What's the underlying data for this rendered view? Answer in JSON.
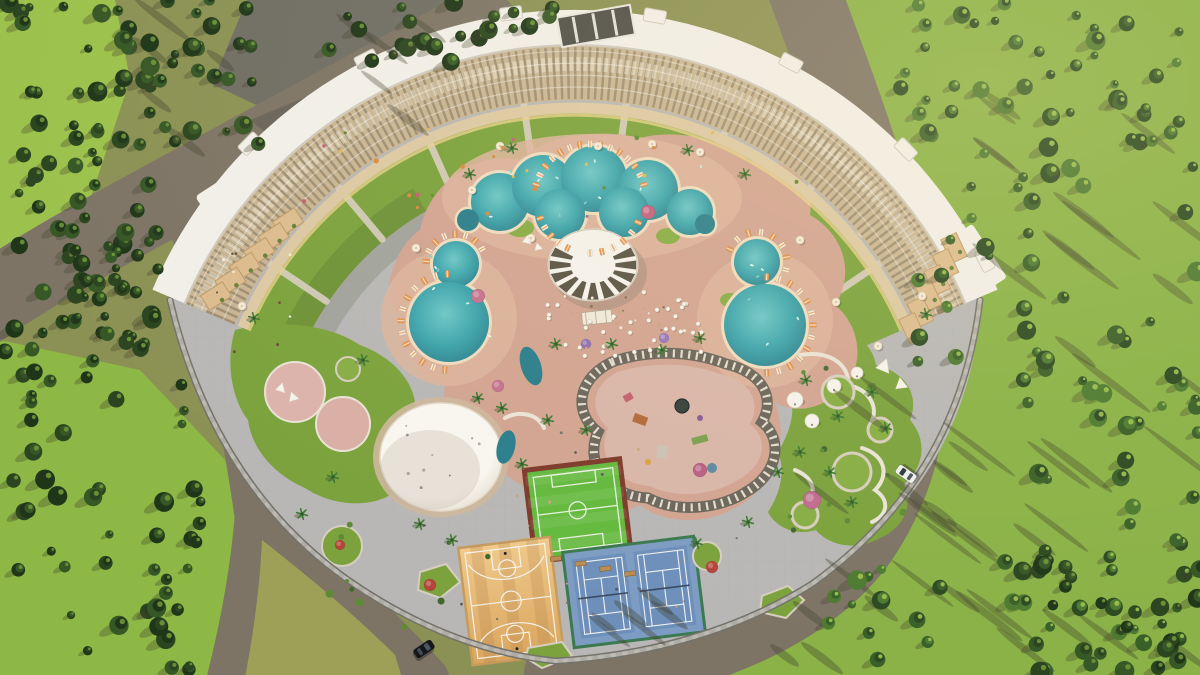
{
  "scene": {
    "kind": "aerial-architectural-render",
    "elements": [
      "curved-hotel-building",
      "swimming-pools",
      "central-sun-canopy",
      "event-dome",
      "mini-football-court",
      "tennis-courts",
      "basketball-court",
      "kids-playground",
      "lazy-track",
      "gardens",
      "perimeter-wall",
      "forest",
      "roads",
      "cars"
    ]
  },
  "colors": {
    "groundOlive": "#8b9154",
    "groundBright": "#8ab247",
    "groundLime": "#9cc14c",
    "bottomLeftBright": "#8db846",
    "medianOlive": "#9fa058",
    "asphalt": "#6f6d64",
    "asphaltShadow": "#55544d",
    "road": "#7d7466",
    "wallLight": "#aeaca4",
    "wallDark": "#73726b",
    "wallPost": "#c9c7c0",
    "plaza": "#b8b7b6",
    "plazaLine": "#a7a6a5",
    "deck": "#d2a492",
    "deckLight": "#ddb49e",
    "island": "#d9b6a9",
    "padPink": "#dcb3ab",
    "padPink2": "#d9aea6",
    "lawn": "#7ba23d",
    "lawnBright": "#87ad45",
    "pathLight": "#d7cec0",
    "gardenPath": "#e9e3d7",
    "water": "#3da5ad",
    "waterDeep": "#2a7e8c",
    "waterLight": "#6cc7c8",
    "poolRim": "#eedcc0",
    "canopyWhite": "#f4f2ec",
    "canopyStripe": "#4c4636",
    "canopyShadow": "#8f8273",
    "roofWhite": "#f1efe9",
    "roofGray": "#d3d6d1",
    "roofEdge": "#cfcabf",
    "facadeTan": "#c9b593",
    "facadeDark": "#6b604f",
    "facadeLight": "#f0e9da",
    "walkway": "#dcc9a4",
    "walkwayEdge": "#e6d089",
    "terraceTan": "#dcbc8f",
    "terraceEdge": "#bd9a68",
    "rampDark": "#4f4e49",
    "courtGreen": "#63b93e",
    "courtBorderRed": "#7c3a2b",
    "tennisBlue": "#7d9cc3",
    "tennisInner": "#6d8fba",
    "tennisEdge": "#3c7950",
    "netDark": "#3a4a63",
    "woodLight": "#f0ca8c",
    "woodDark": "#d9a55e",
    "woodEdge": "#c59c5e",
    "lineWhite": "#f7f7f4",
    "benchTan": "#b98c54",
    "loungerOrange": "#e79346",
    "loungerWhite": "#f3ece0",
    "umbrellaCream": "#f3ead8",
    "tentWhite": "#f6f3ec",
    "palmDark": "#2e5b2a",
    "palmFrond": "#3f7a33",
    "treeShadow": "#3e3e2c",
    "domeWhite": "#f8f6f0",
    "domeEdge": "#e3d9ca",
    "domeRing": "#cdb79c",
    "treeDark1": "#1f3619",
    "treeDark2": "#2a451f",
    "treeDark3": "#365726",
    "treeMid1": "#2c4a22",
    "treeMid2": "#3a6029",
    "treeMid3": "#4d7a31",
    "treeCap": "#6f9638",
    "treeCapBright": "#9dc24f",
    "sunGlow": "#ffe9b0"
  },
  "procedural": {
    "forests": [
      {
        "box": [
          0,
          0,
          152,
          335
        ],
        "n": 62,
        "seed": 11,
        "pal": "dark"
      },
      {
        "box": [
          148,
          0,
          112,
          148
        ],
        "n": 26,
        "seed": 12,
        "pal": "dark"
      },
      {
        "box": [
          328,
          0,
          128,
          64
        ],
        "n": 14,
        "seed": 13,
        "pal": "dark"
      },
      {
        "box": [
          58,
          206,
          118,
          136
        ],
        "n": 18,
        "seed": 14,
        "pal": "dark"
      },
      {
        "box": [
          0,
          332,
          212,
          343
        ],
        "n": 56,
        "seed": 15,
        "pal": "dark"
      },
      {
        "box": [
          455,
          0,
          100,
          52
        ],
        "n": 9,
        "seed": 16,
        "pal": "dark"
      },
      {
        "box": [
          872,
          0,
          328,
          136
        ],
        "n": 40,
        "seed": 17,
        "pal": "mid"
      },
      {
        "box": [
          1002,
          132,
          198,
          543
        ],
        "n": 64,
        "seed": 18,
        "pal": "mid"
      },
      {
        "box": [
          903,
          132,
          104,
          232
        ],
        "n": 14,
        "seed": 19,
        "pal": "mid"
      },
      {
        "box": [
          1022,
          556,
          178,
          119
        ],
        "n": 26,
        "seed": 20,
        "pal": "dark"
      },
      {
        "box": [
          828,
          556,
          164,
          112
        ],
        "n": 12,
        "seed": 21,
        "pal": "mid"
      }
    ],
    "shadow_streaks": [
      {
        "box": [
          936,
          50,
          264,
          610
        ],
        "n": 30,
        "seed": 31,
        "len": [
          45,
          100
        ]
      },
      {
        "box": [
          818,
          360,
          172,
          280
        ],
        "n": 14,
        "seed": 32,
        "len": [
          35,
          80
        ]
      },
      {
        "box": [
          556,
          592,
          300,
          78
        ],
        "n": 9,
        "seed": 33,
        "len": [
          28,
          60
        ]
      },
      {
        "box": [
          150,
          14,
          282,
          128
        ],
        "n": 10,
        "seed": 34,
        "len": [
          30,
          70
        ]
      }
    ],
    "lounger_arcs": [
      {
        "cx": 590,
        "cy": 200,
        "r": 56,
        "a0": 196,
        "a1": 344,
        "n": 15
      },
      {
        "cx": 590,
        "cy": 200,
        "r": 53,
        "a0": 25,
        "a1": 90,
        "n": 6
      },
      {
        "cx": 590,
        "cy": 200,
        "r": 53,
        "a0": 115,
        "a1": 160,
        "n": 5
      },
      {
        "cx": 449,
        "cy": 322,
        "r": 48,
        "a0": 95,
        "a1": 268,
        "n": 13
      },
      {
        "cx": 456,
        "cy": 264,
        "r": 30,
        "a0": 185,
        "a1": 330,
        "n": 8
      },
      {
        "cx": 765,
        "cy": 325,
        "r": 48,
        "a0": -88,
        "a1": 88,
        "n": 13
      },
      {
        "cx": 757,
        "cy": 262,
        "r": 30,
        "a0": -155,
        "a1": 15,
        "n": 8
      }
    ],
    "tables": {
      "box": [
        545,
        292,
        158,
        64
      ],
      "n": 40,
      "seed": 41,
      "avoid": [
        593,
        265,
        56,
        46
      ]
    },
    "canopy": {
      "cx": 593,
      "cy": 265,
      "rx": 45,
      "ry": 36,
      "wedges": 16,
      "skip": [
        222,
        318
      ],
      "ri": 0.5,
      "ro": 0.97
    },
    "spokes": {
      "cx": 575,
      "cy": 469,
      "r0": 368,
      "r1": 300,
      "angles": [
        214,
        230,
        246,
        262,
        278,
        294,
        310,
        326
      ],
      "width": 7
    },
    "roof_bumps": {
      "angles": [
        225,
        243,
        262,
        280,
        298,
        316,
        333
      ],
      "radius": 460,
      "w": 22,
      "h": 13
    },
    "terrace_steps": [
      {
        "from": [
          288,
          222
        ],
        "to": [
          216,
          296
        ],
        "n": 6,
        "rot": -33,
        "w": 26,
        "h": 17
      },
      {
        "from": [
          954,
          248
        ],
        "to": [
          912,
          328
        ],
        "n": 6,
        "rot": 65,
        "w": 26,
        "h": 17
      }
    ],
    "pools": {
      "blob_circles": [
        [
          500,
          202,
          29
        ],
        [
          543,
          186,
          31
        ],
        [
          594,
          179,
          33
        ],
        [
          648,
          190,
          30
        ],
        [
          690,
          212,
          23
        ],
        [
          560,
          214,
          25
        ],
        [
          624,
          212,
          25
        ],
        [
          456,
          264,
          23
        ],
        [
          449,
          322,
          40
        ],
        [
          757,
          262,
          23
        ],
        [
          765,
          325,
          41
        ]
      ],
      "round_pools": [
        [
          468,
          220,
          11
        ],
        [
          705,
          224,
          10
        ],
        [
          868,
          228,
          9
        ]
      ],
      "crescents": [
        [
          531,
          366,
          10,
          20,
          -18
        ],
        [
          506,
          447,
          9,
          17,
          14
        ]
      ]
    },
    "palms": [
      [
        363,
        360
      ],
      [
        333,
        477
      ],
      [
        302,
        514
      ],
      [
        420,
        524
      ],
      [
        452,
        540
      ],
      [
        478,
        398
      ],
      [
        502,
        408
      ],
      [
        522,
        464
      ],
      [
        556,
        344
      ],
      [
        612,
        344
      ],
      [
        662,
        350
      ],
      [
        700,
        338
      ],
      [
        748,
        522
      ],
      [
        697,
        543
      ],
      [
        778,
        472
      ],
      [
        800,
        452
      ],
      [
        830,
        472
      ],
      [
        852,
        502
      ],
      [
        886,
        428
      ],
      [
        838,
        416
      ],
      [
        806,
        380
      ],
      [
        872,
        392
      ],
      [
        512,
        148
      ],
      [
        470,
        174
      ],
      [
        688,
        150
      ],
      [
        745,
        174
      ],
      [
        254,
        318
      ],
      [
        926,
        314
      ],
      [
        586,
        430
      ],
      [
        548,
        420
      ]
    ],
    "umbrellas": [
      [
        500,
        146
      ],
      [
        472,
        190
      ],
      [
        700,
        152
      ],
      [
        800,
        240
      ],
      [
        836,
        302
      ],
      [
        416,
        248
      ],
      [
        242,
        306
      ],
      [
        922,
        296
      ],
      [
        878,
        346
      ],
      [
        531,
        238
      ],
      [
        598,
        146
      ],
      [
        652,
        144
      ]
    ],
    "tents": [
      [
        795,
        400,
        8
      ],
      [
        812,
        421,
        7
      ],
      [
        834,
        386,
        7
      ],
      [
        857,
        373,
        6
      ]
    ],
    "sails": [
      [
        884,
        366,
        13,
        20
      ],
      [
        901,
        384,
        11,
        -10
      ],
      [
        281,
        388,
        9,
        15
      ],
      [
        293,
        397,
        9,
        -20
      ],
      [
        527,
        240,
        8,
        10
      ],
      [
        538,
        247,
        7,
        -15
      ]
    ],
    "flowers": [
      [
        648,
        212,
        7,
        "#c2607f"
      ],
      [
        812,
        500,
        9,
        "#c06a8f"
      ],
      [
        700,
        470,
        7,
        "#b85f85"
      ],
      [
        478,
        296,
        7,
        "#c4728f"
      ],
      [
        586,
        344,
        5,
        "#8f6fb5"
      ],
      [
        664,
        338,
        5,
        "#9a77bf"
      ],
      [
        712,
        567,
        6,
        "#b5443a"
      ],
      [
        430,
        585,
        6,
        "#b5443a"
      ],
      [
        340,
        545,
        5,
        "#b5443a"
      ],
      [
        498,
        386,
        6,
        "#c4728f"
      ]
    ],
    "bush_clusters": [
      {
        "box": [
          788,
          352,
          140,
          180
        ],
        "n": 12,
        "seed": 58
      },
      {
        "box": [
          300,
          520,
          200,
          110
        ],
        "n": 10,
        "seed": 59
      }
    ],
    "people_clusters": [
      {
        "box": [
          548,
          292,
          150,
          62
        ],
        "n": 24,
        "seed": 51,
        "colors": [
          "#f2ead9",
          "#caa27d",
          "#8f6f52"
        ],
        "r": 1.2
      },
      {
        "box": [
          410,
          430,
          340,
          190
        ],
        "n": 18,
        "seed": 52,
        "colors": [
          "#5a5a55",
          "#77736a",
          "#caa27d"
        ],
        "r": 1.2
      },
      {
        "box": [
          300,
          120,
          500,
          110
        ],
        "n": 26,
        "seed": 53,
        "colors": [
          "#d98a3f",
          "#c4606f",
          "#e0b84f",
          "#5d8a35"
        ],
        "r": 2
      },
      {
        "box": [
          200,
          240,
          92,
          112
        ],
        "n": 10,
        "seed": 54,
        "colors": [
          "#6b4f38",
          "#f2ead9"
        ],
        "r": 1.4
      },
      {
        "box": [
          404,
          424,
          76,
          64
        ],
        "n": 8,
        "seed": 60,
        "colors": [
          "#97917f",
          "#b0a897"
        ],
        "r": 1.3
      }
    ],
    "float_clusters": [
      {
        "box": [
          482,
          160,
          220,
          76
        ],
        "n": 12,
        "seed": 55
      },
      {
        "box": [
          414,
          250,
          76,
          108
        ],
        "n": 6,
        "seed": 56
      },
      {
        "box": [
          730,
          250,
          74,
          110
        ],
        "n": 6,
        "seed": 57
      }
    ],
    "cars": [
      {
        "x": 424,
        "y": 649,
        "rot": 56,
        "body": "#17171a",
        "glass": "#4a5663"
      },
      {
        "x": 906,
        "y": 474,
        "rot": -55,
        "body": "#eef0ee",
        "glass": "#2e3741"
      }
    ]
  }
}
